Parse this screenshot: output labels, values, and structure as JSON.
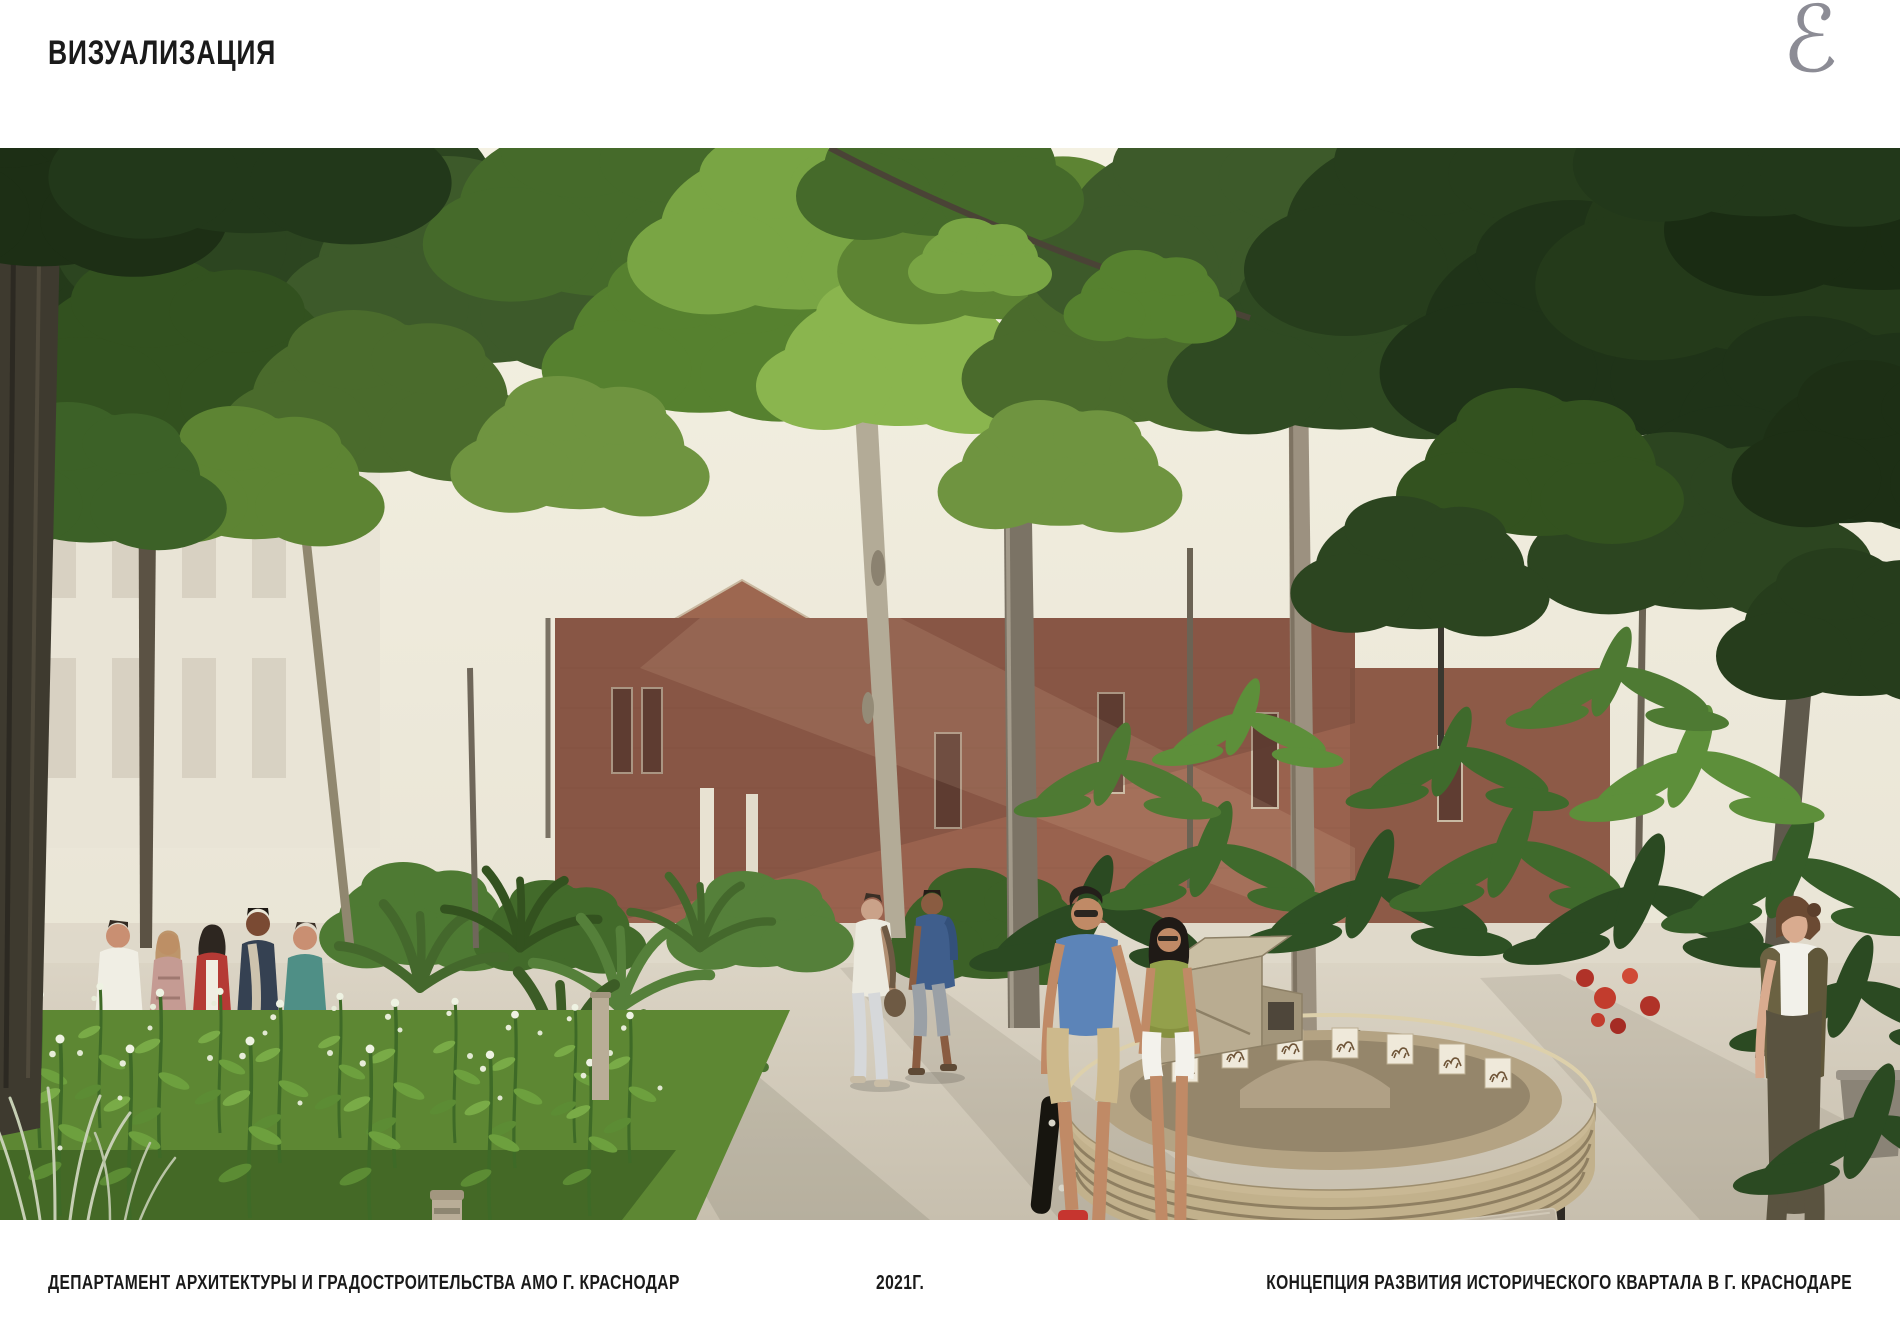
{
  "page": {
    "title": "ВИЗУАЛИЗАЦИЯ"
  },
  "logo": {
    "glyph": "ℰ"
  },
  "footer": {
    "left": "ДЕПАРТАМЕНТ АРХИТЕКТУРЫ И ГРАДОСТРОИТЕЛЬСТВА АМО Г. КРАСНОДАР",
    "center": "2021Г.",
    "right": "КОНЦЕПЦИЯ РАЗВИТИЯ ИСТОРИЧЕСКОГО КВАРТАЛА В Г. КРАСНОДАРЕ"
  },
  "render": {
    "plaque_lines": [
      "Живые фотографии",
      "демонстрировались в",
      "Екатеринодаре на год раньше",
      "парижского киносеанса",
      "братьев Люмьер и на два года",
      "раньше первых киносеансов в",
      "Москве и Петербурге"
    ]
  },
  "colors": {
    "foliage_dark": "#2c4520",
    "foliage_mid": "#4a6b2c",
    "foliage_light": "#8ab54e",
    "brick": "#97614d",
    "path": "#cfc7b7",
    "wood_installation": "#c9b894",
    "plaque_stone": "#b2a895",
    "logo_gray": "#8c8c95"
  }
}
